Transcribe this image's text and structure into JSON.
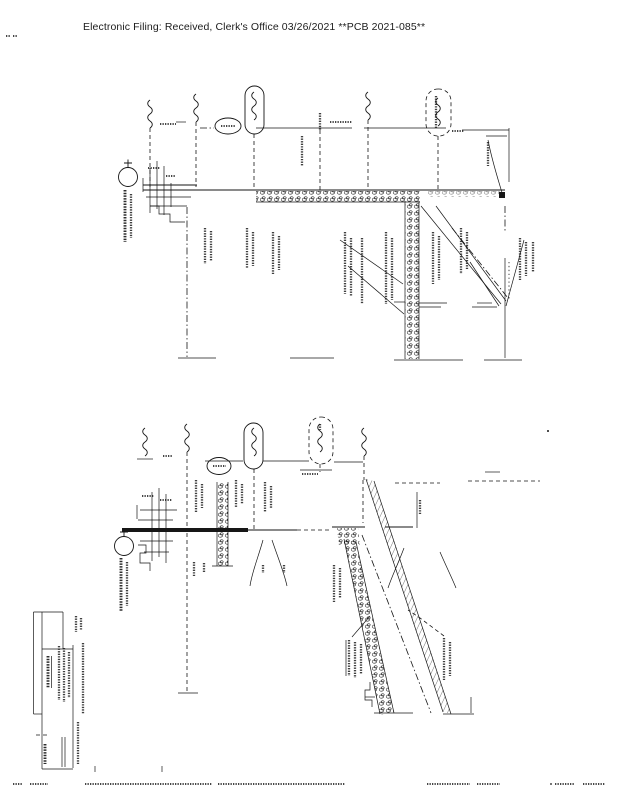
{
  "header": {
    "text": "Electronic Filing: Received, Clerk's Office 03/26/2021 **PCB 2021-085**"
  },
  "page": {
    "background": "#ffffff",
    "ink_color": "#161616",
    "content_note": "scanned engineering cross-section drawing, rotated 90 degrees; all drawing labels and title block text are illegible scan marks"
  }
}
